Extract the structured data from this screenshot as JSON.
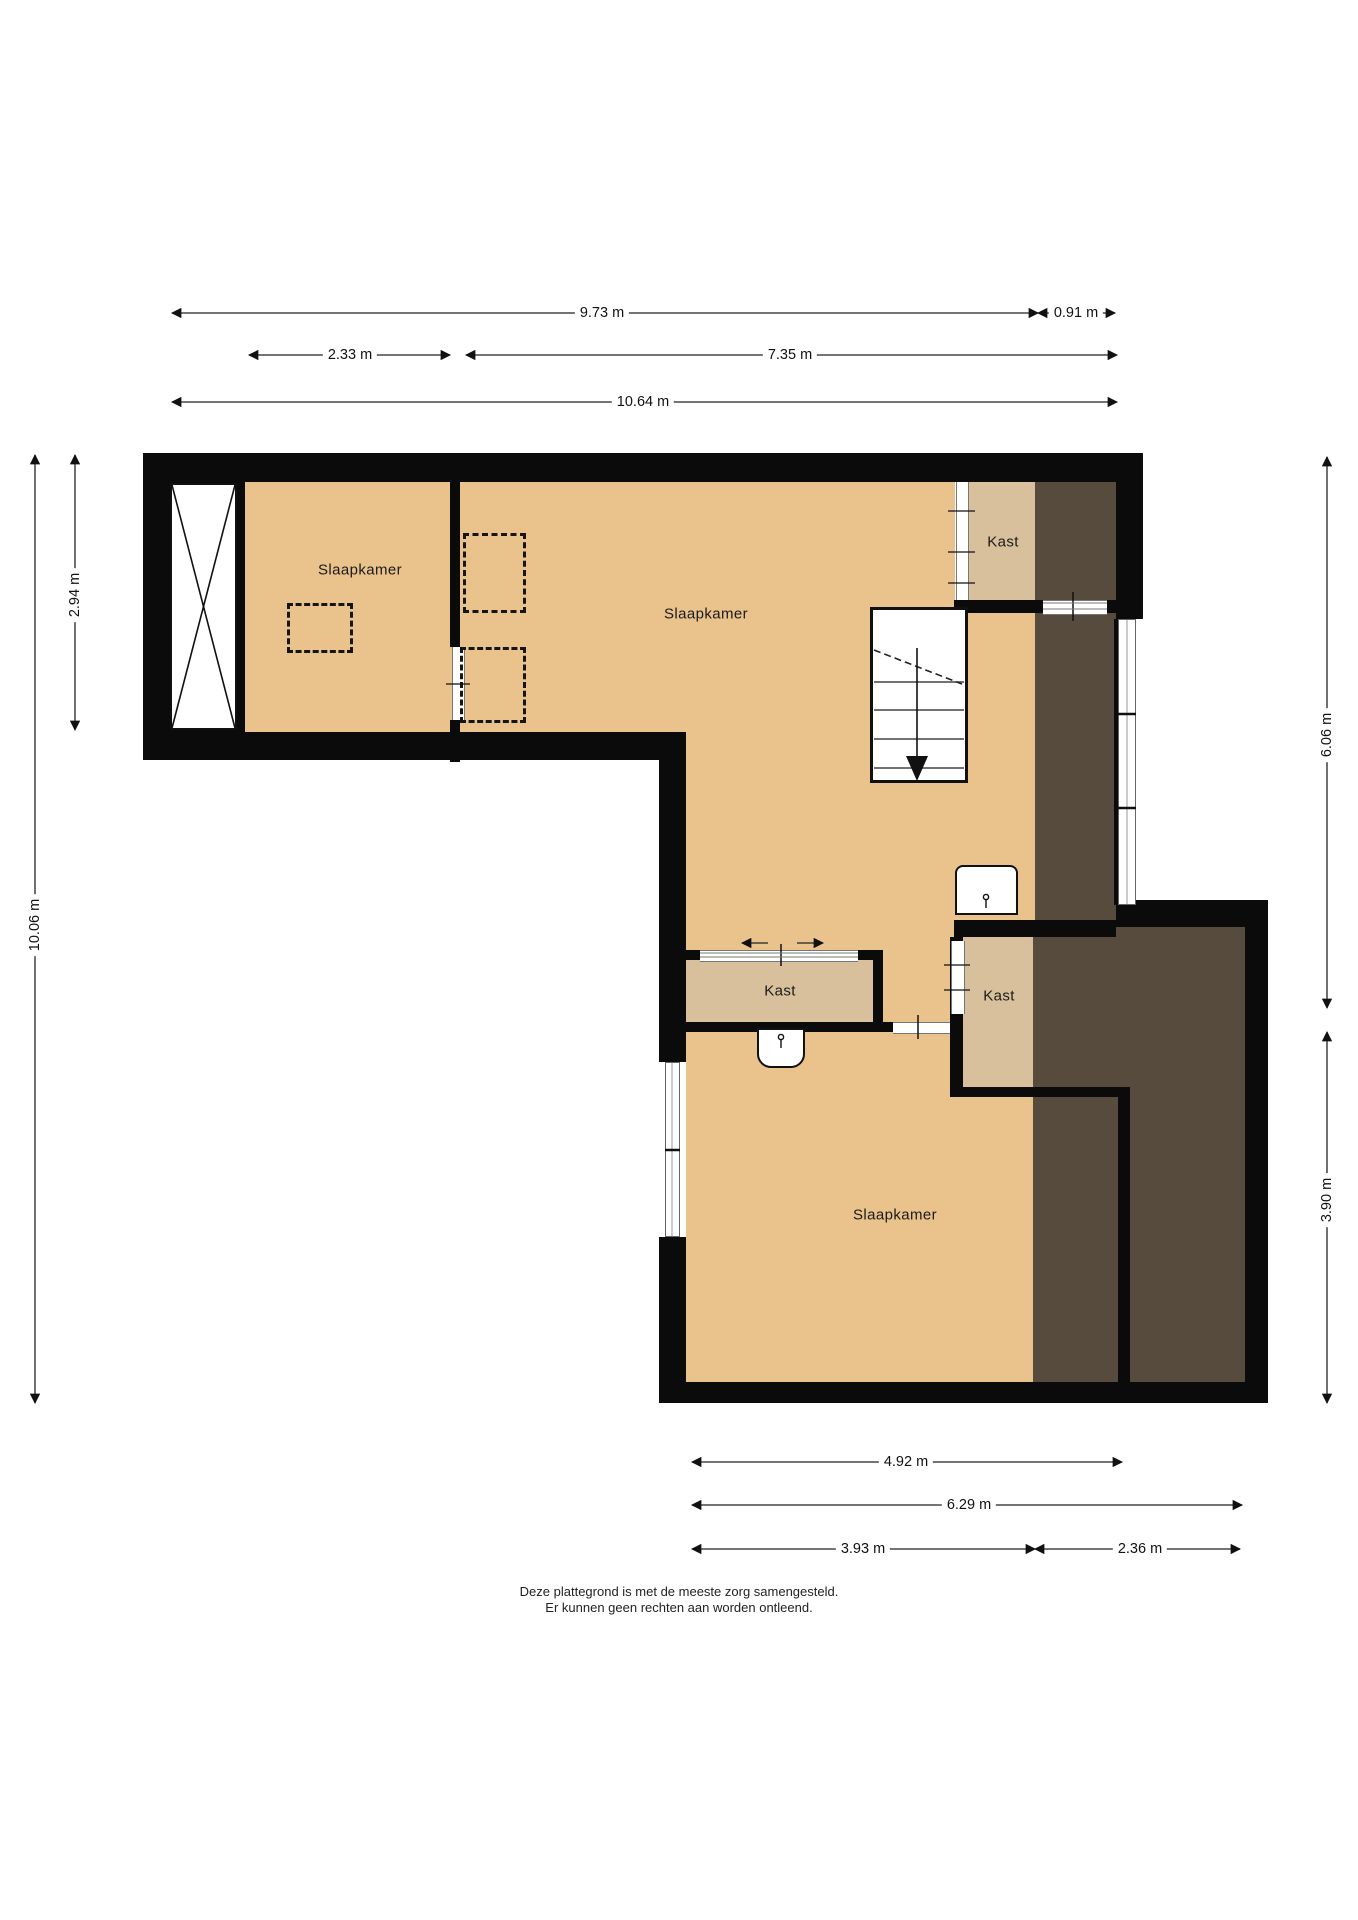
{
  "floorplan": {
    "rooms": [
      {
        "id": "slaapkamer-1",
        "label": "Slaapkamer"
      },
      {
        "id": "slaapkamer-2",
        "label": "Slaapkamer"
      },
      {
        "id": "slaapkamer-3",
        "label": "Slaapkamer"
      },
      {
        "id": "kast-1",
        "label": "Kast"
      },
      {
        "id": "kast-2",
        "label": "Kast"
      },
      {
        "id": "kast-3",
        "label": "Kast"
      }
    ],
    "dimensions": {
      "top": [
        {
          "label": "9.73 m"
        },
        {
          "label": "0.91 m"
        },
        {
          "label": "2.33 m"
        },
        {
          "label": "7.35 m"
        },
        {
          "label": "10.64 m"
        }
      ],
      "bottom": [
        {
          "label": "4.92 m"
        },
        {
          "label": "6.29 m"
        },
        {
          "label": "3.93 m"
        },
        {
          "label": "2.36 m"
        }
      ],
      "left": [
        {
          "label": "2.94 m"
        },
        {
          "label": "10.06 m"
        }
      ],
      "right": [
        {
          "label": "6.06 m"
        },
        {
          "label": "3.90 m"
        }
      ]
    },
    "footer": {
      "line1": "Deze plattegrond is met de meeste zorg samengesteld.",
      "line2": "Er kunnen geen rechten aan worden ontleend."
    },
    "colors": {
      "floor": "#EAC28C",
      "closet_floor": "#D9C09D",
      "low_ceiling": "#564B3C",
      "wall": "#0B0B0B"
    }
  }
}
